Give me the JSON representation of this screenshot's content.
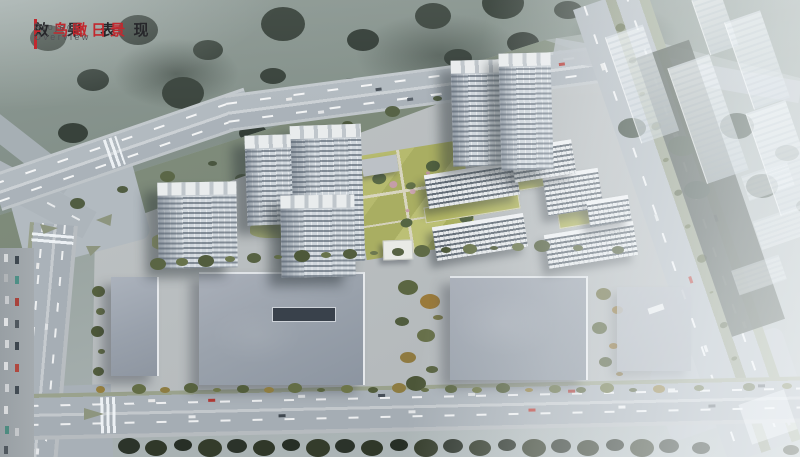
{
  "header": {
    "title_cn": "效 果 表 现",
    "title_accent": "- 鸟瞰日景",
    "subtitle": "Project Overview",
    "accent_color": "#c2282e"
  },
  "scene": {
    "type": "architectural-aerial-rendering",
    "time_of_day": "day",
    "palette": {
      "forest_ground": "#87938e",
      "forest_trees": "#3a443d",
      "grass_belt": "#7f8c81",
      "road_asphalt": "#aab2b9",
      "site_paving": "#bcc0c2",
      "commercial_roof": "#9aa2ac",
      "tower_facade": "#cfd6dc",
      "tower_roof": "#e9eced",
      "slab_window_band": "#3a4652",
      "lawn_yellow_green": "#b2b664",
      "autumn_tree": "#97803f",
      "dark_tree_band": "#2c342a",
      "haze_white": "#f6fafc",
      "car_red": "#b23a35"
    }
  }
}
